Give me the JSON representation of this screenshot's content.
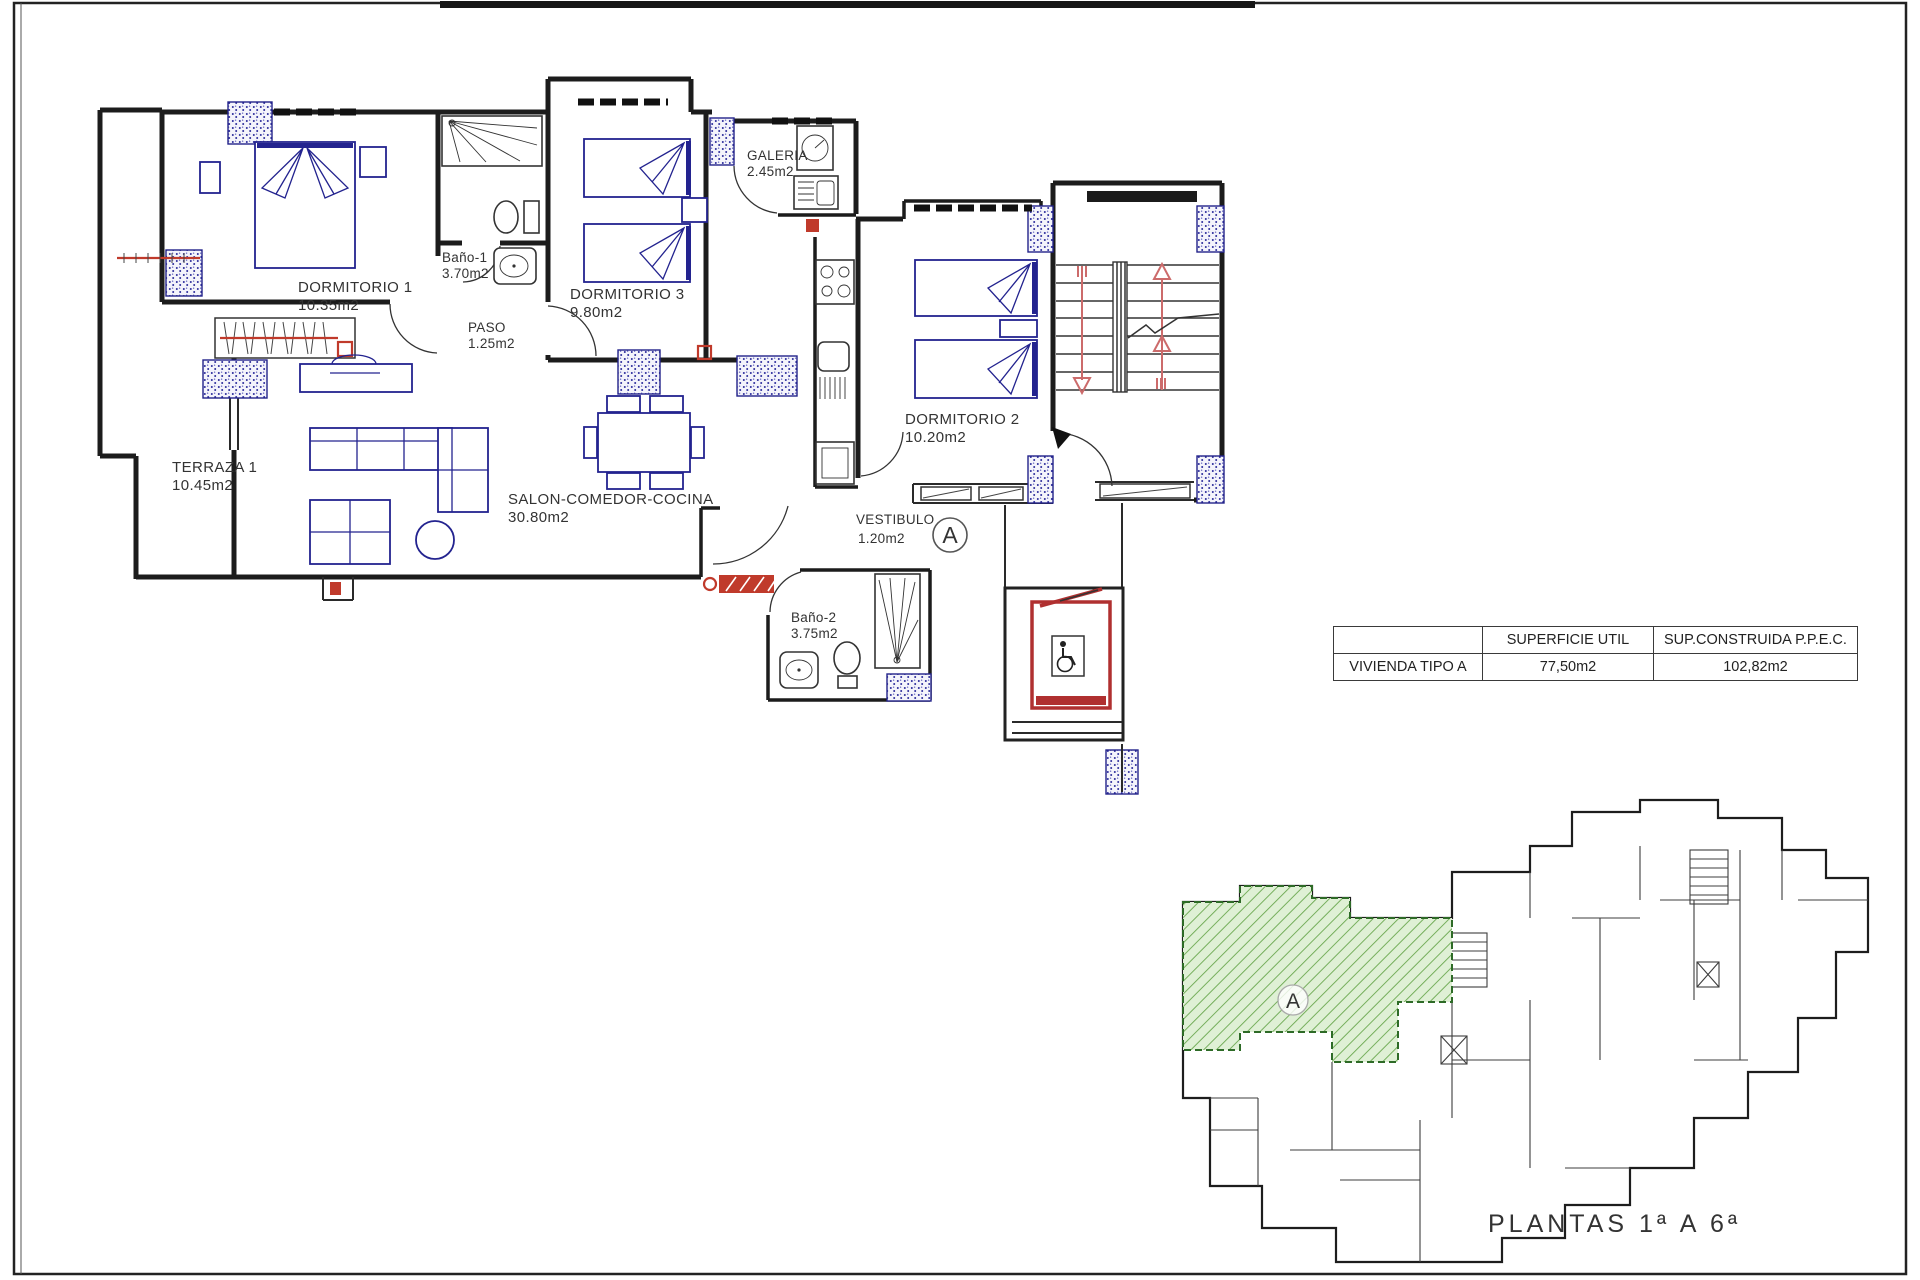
{
  "floor_plan": {
    "section_marker": "A",
    "rooms": [
      {
        "name": "dormitorio-1",
        "label": "DORMITORIO 1",
        "area": "10.35m2"
      },
      {
        "name": "bano-1",
        "label": "Baño-1",
        "area": "3.70m2"
      },
      {
        "name": "paso",
        "label": "PASO",
        "area": "1.25m2"
      },
      {
        "name": "dormitorio-3",
        "label": "DORMITORIO 3",
        "area": "9.80m2"
      },
      {
        "name": "galeria",
        "label": "GALERIA",
        "area": "2.45m2"
      },
      {
        "name": "dormitorio-2",
        "label": "DORMITORIO 2",
        "area": "10.20m2"
      },
      {
        "name": "terraza-1",
        "label": "TERRAZA 1",
        "area": "10.45m2"
      },
      {
        "name": "salon",
        "label": "SALON-COMEDOR-COCINA",
        "area": "30.80m2"
      },
      {
        "name": "vestibulo",
        "label": "VESTIBULO",
        "area": "1.20m2"
      },
      {
        "name": "bano-2",
        "label": "Baño-2",
        "area": "3.75m2"
      }
    ]
  },
  "summary_table": {
    "headers": [
      "",
      "SUPERFICIE UTIL",
      "SUP.CONSTRUIDA P.P.E.C."
    ],
    "row": {
      "name": "VIVIENDA TIPO A",
      "superficie_util": "77,50m2",
      "sup_construida": "102,82m2"
    }
  },
  "key_plan": {
    "unit_label": "A",
    "caption": "PLANTAS 1ª A 6ª"
  },
  "colors": {
    "walls": "#1c1c1c",
    "furniture": "#23238f",
    "accent_red": "#c03a2b",
    "stairs_red": "#cc6b6b",
    "highlight_green_fill": "#dff0d5",
    "highlight_green_line": "#6aa84f"
  }
}
